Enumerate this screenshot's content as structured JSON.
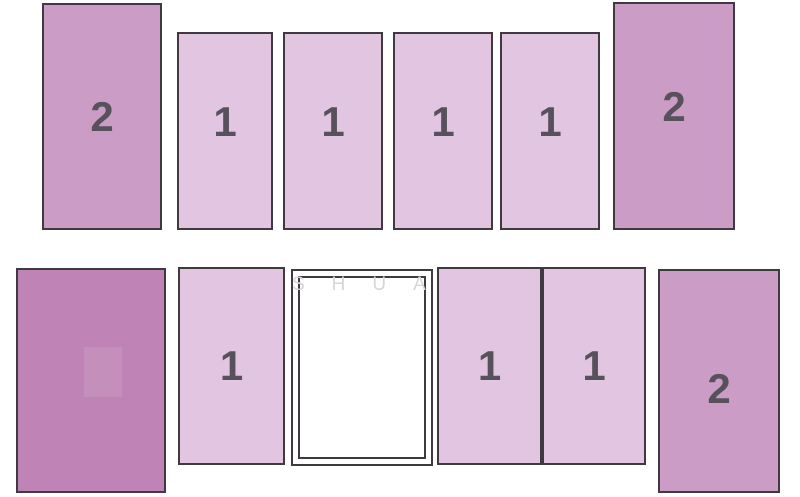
{
  "diagram": {
    "description": "Two-row berth layout diagram with numbered tier blocks",
    "background_color": "#ffffff",
    "border_color": "#3e3a40",
    "digit_color": "#56515a",
    "tier1_fill": "#e2c5e0",
    "tier2_fill": "#cb9dc6",
    "dark_fill": "#bf84b5",
    "watermark": {
      "text": "SHUA",
      "color": "#d6d6d6"
    },
    "blocks": [
      {
        "name": "berth-2-top-left",
        "label": "2"
      },
      {
        "name": "berth-1-top-a",
        "label": "1"
      },
      {
        "name": "berth-1-top-b",
        "label": "1"
      },
      {
        "name": "berth-1-top-c",
        "label": "1"
      },
      {
        "name": "berth-1-top-d",
        "label": "1"
      },
      {
        "name": "berth-2-top-right",
        "label": "2"
      },
      {
        "name": "dark-block",
        "label": ""
      },
      {
        "name": "berth-1-bottom-left",
        "label": "1"
      },
      {
        "name": "white-panel",
        "label": ""
      },
      {
        "name": "berth-1-bottom-mid-a",
        "label": "1"
      },
      {
        "name": "berth-1-bottom-mid-b",
        "label": "1"
      },
      {
        "name": "berth-2-bottom-right",
        "label": "2"
      }
    ]
  }
}
